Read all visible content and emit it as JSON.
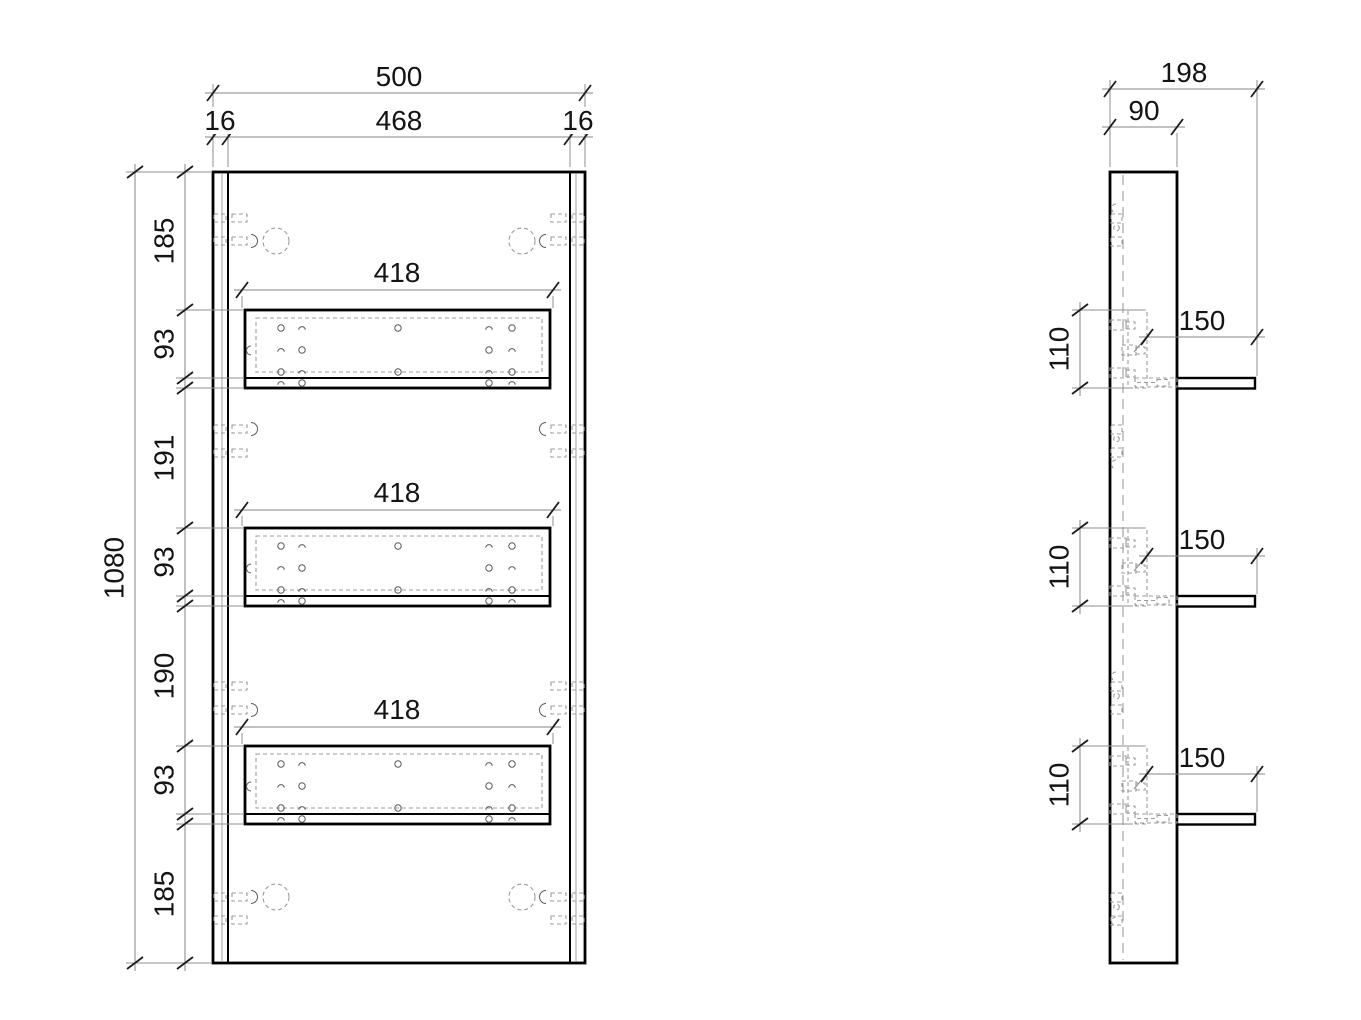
{
  "colors": {
    "line": "#000000",
    "dimension": "#848484",
    "hidden_dashed": "#9c9c9c",
    "text": "#141414",
    "background": "#ffffff"
  },
  "front_view": {
    "width_total": "500",
    "edge_left": "16",
    "width_inner": "468",
    "edge_right": "16",
    "height_total": "1080",
    "height_chain": [
      "185",
      "93",
      "191",
      "93",
      "190",
      "93",
      "185"
    ],
    "shelf_widths": [
      "418",
      "418",
      "418"
    ]
  },
  "side_view": {
    "depth_total": "198",
    "panel_depth": "90",
    "shelf_depths": [
      "150",
      "150",
      "150"
    ],
    "shelf_heights": [
      "110",
      "110",
      "110"
    ]
  }
}
